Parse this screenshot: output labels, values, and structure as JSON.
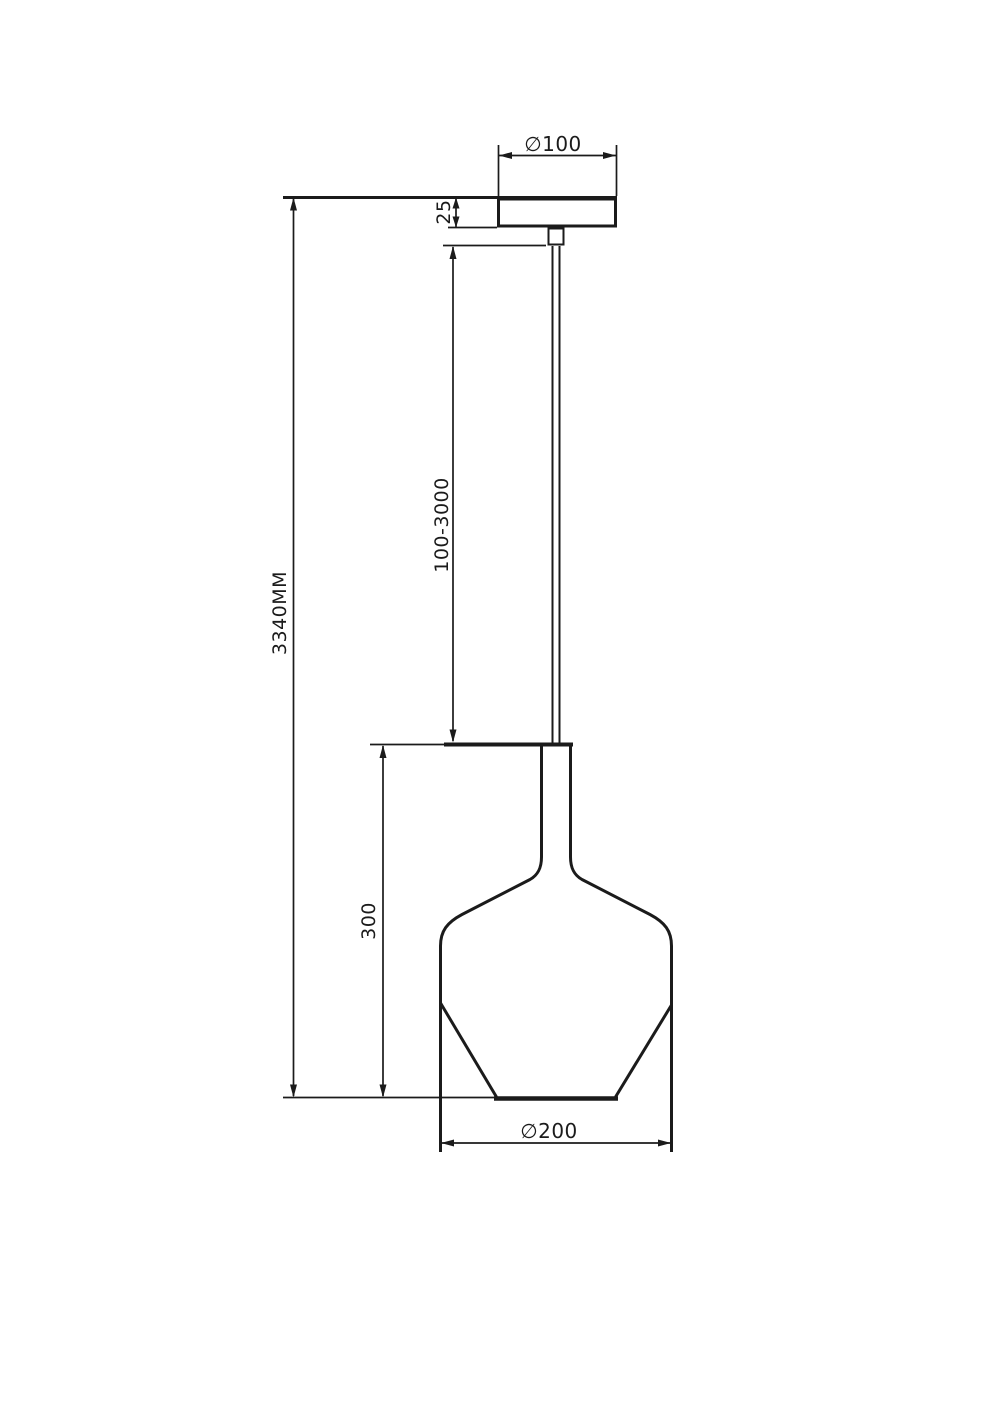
{
  "drawing": {
    "dimensions": {
      "canopy_diameter": "∅100",
      "canopy_height": "25",
      "suspension_length": "100-3000",
      "overall_height": "3340MM",
      "shade_height": "300",
      "shade_diameter": "∅200"
    },
    "colors": {
      "line": "#1b1b1b",
      "background": "#ffffff"
    }
  }
}
